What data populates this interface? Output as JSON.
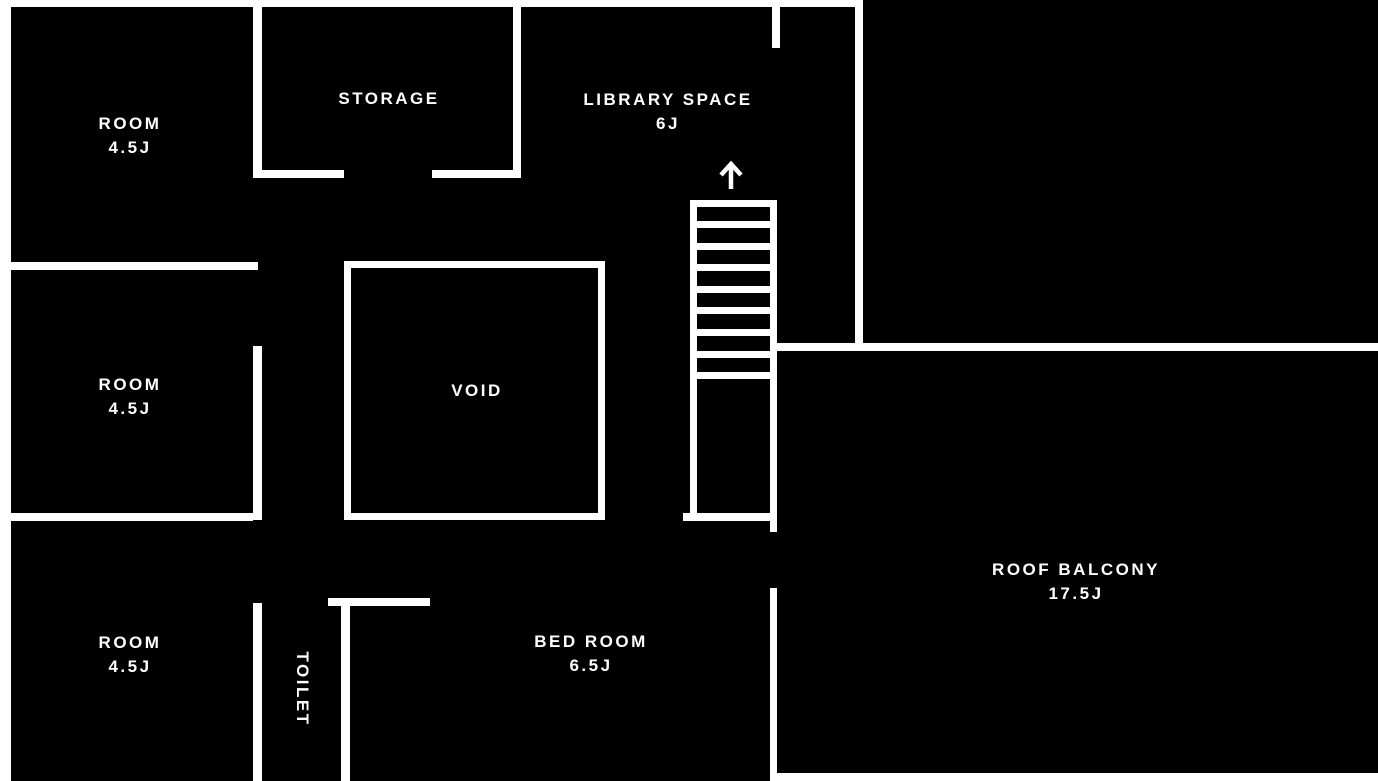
{
  "colors": {
    "background": "#000000",
    "wall": "#ffffff",
    "label": "#ffffff"
  },
  "rooms": [
    {
      "label": "ROOM",
      "size": "4.5J",
      "position": "top-left"
    },
    {
      "label": "STORAGE",
      "size": "",
      "position": "top-middle"
    },
    {
      "label": "LIBRARY SPACE",
      "size": "6J",
      "position": "top-right"
    },
    {
      "label": "ROOM",
      "size": "4.5J",
      "position": "middle-left"
    },
    {
      "label": "VOID",
      "size": "",
      "position": "center"
    },
    {
      "label": "ROOM",
      "size": "4.5J",
      "position": "bottom-left"
    },
    {
      "label": "TOILET",
      "size": "",
      "position": "bottom-middle-left"
    },
    {
      "label": "BED ROOM",
      "size": "6.5J",
      "position": "bottom-middle"
    },
    {
      "label": "ROOF BALCONY",
      "size": "17.5J",
      "position": "right"
    }
  ],
  "stairs": {
    "steps": 8,
    "direction_icon": "up-arrow"
  }
}
